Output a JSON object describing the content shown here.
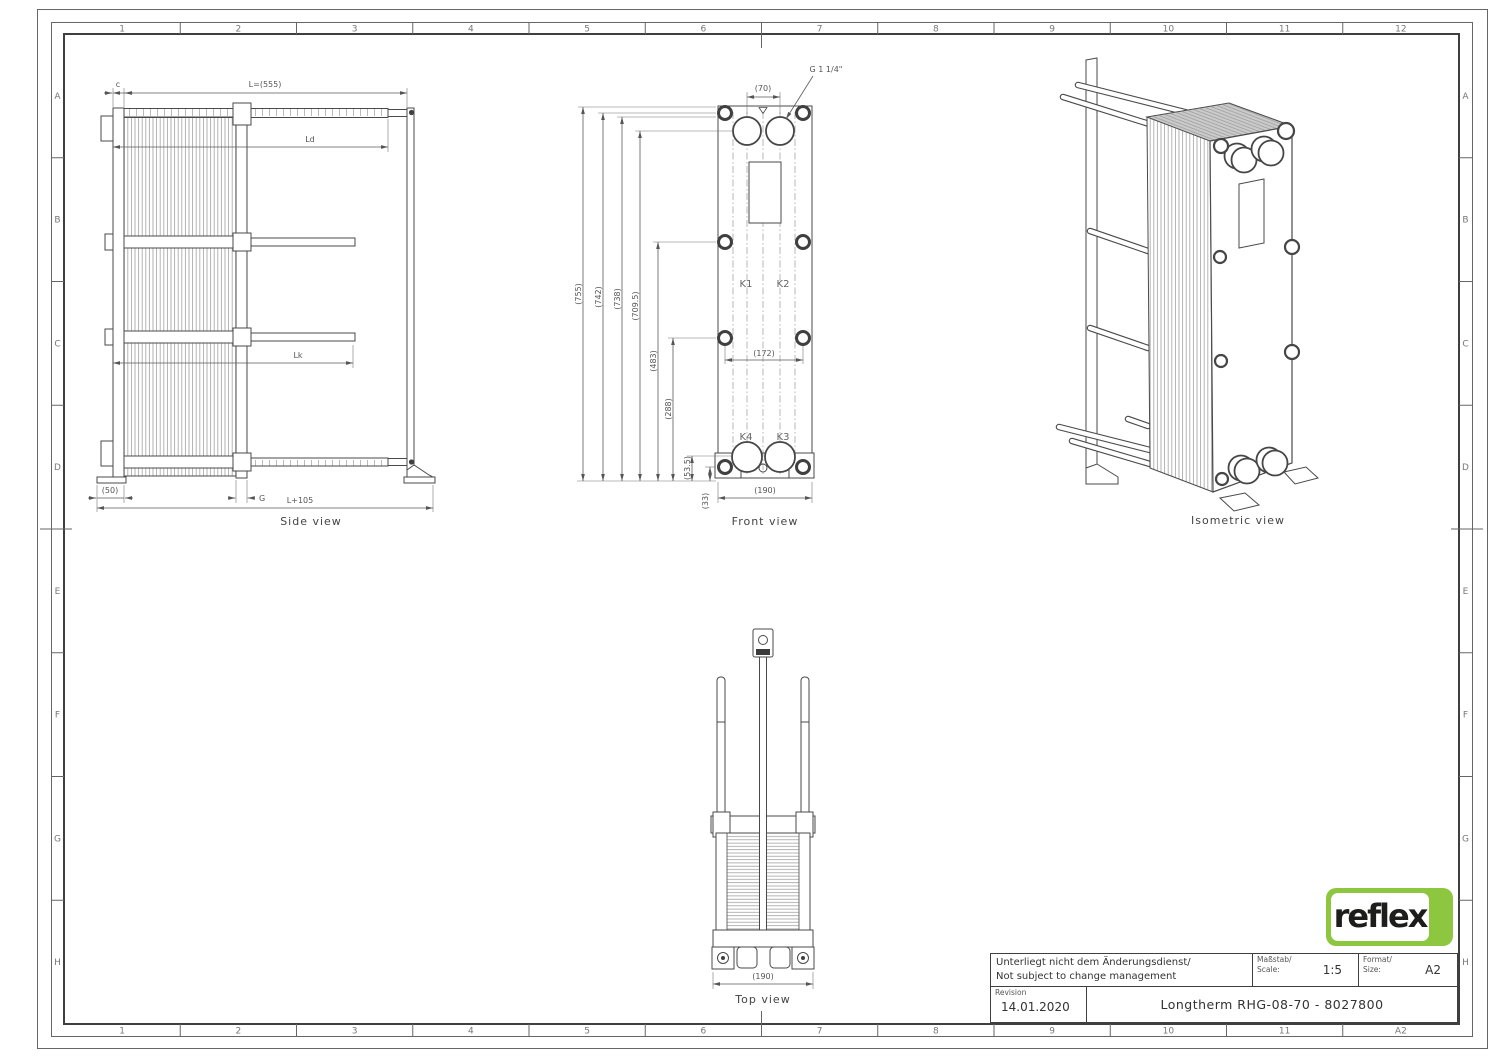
{
  "sheet": {
    "border_cols": [
      "1",
      "2",
      "3",
      "4",
      "5",
      "6",
      "7",
      "8",
      "9",
      "10",
      "11",
      "12"
    ],
    "border_cols_bottom": [
      "1",
      "2",
      "3",
      "4",
      "5",
      "6",
      "7",
      "8",
      "9",
      "10",
      "11",
      "A2"
    ],
    "border_rows": [
      "A",
      "B",
      "C",
      "D",
      "E",
      "F",
      "G",
      "H"
    ]
  },
  "side_view": {
    "label": "Side view",
    "dim_c": "c",
    "dim_L": "L=(555)",
    "dim_Ld": "Ld",
    "dim_Lk": "Lk",
    "dim_foot": "(50)",
    "dim_G": "G",
    "dim_total": "L+105"
  },
  "front_view": {
    "label": "Front view",
    "dim_port_spacing": "(70)",
    "port_thread": "G 1 1/4\"",
    "dim_heights": [
      "(755)",
      "(742)",
      "(738)",
      "(709.5)",
      "(483)",
      "(288)",
      "(53.5)",
      "(33)"
    ],
    "dim_bolt_spacing": "(172)",
    "dim_width": "(190)",
    "port_k1": "K1",
    "port_k2": "K2",
    "port_k3": "K3",
    "port_k4": "K4"
  },
  "iso_view": {
    "label": "Isometric view"
  },
  "top_view": {
    "label": "Top view",
    "dim_width": "(190)"
  },
  "title_block": {
    "note_line1": "Unterliegt nicht dem Änderungsdienst/",
    "note_line2": "Not subject to change management",
    "scale_label_de": "Maßstab/",
    "scale_label_en": "Scale:",
    "scale_value": "1:5",
    "format_label_de": "Format/",
    "format_label_en": "Size:",
    "format_value": "A2",
    "revision_label": "Revision",
    "revision_value": "14.01.2020",
    "drawing_title": "Longtherm RHG-08-70 - 8027800"
  },
  "logo": {
    "text": "reflex"
  },
  "colors": {
    "logo_green": "#8dc63f",
    "line": "#4a4a4a",
    "dim_text": "#555555"
  }
}
